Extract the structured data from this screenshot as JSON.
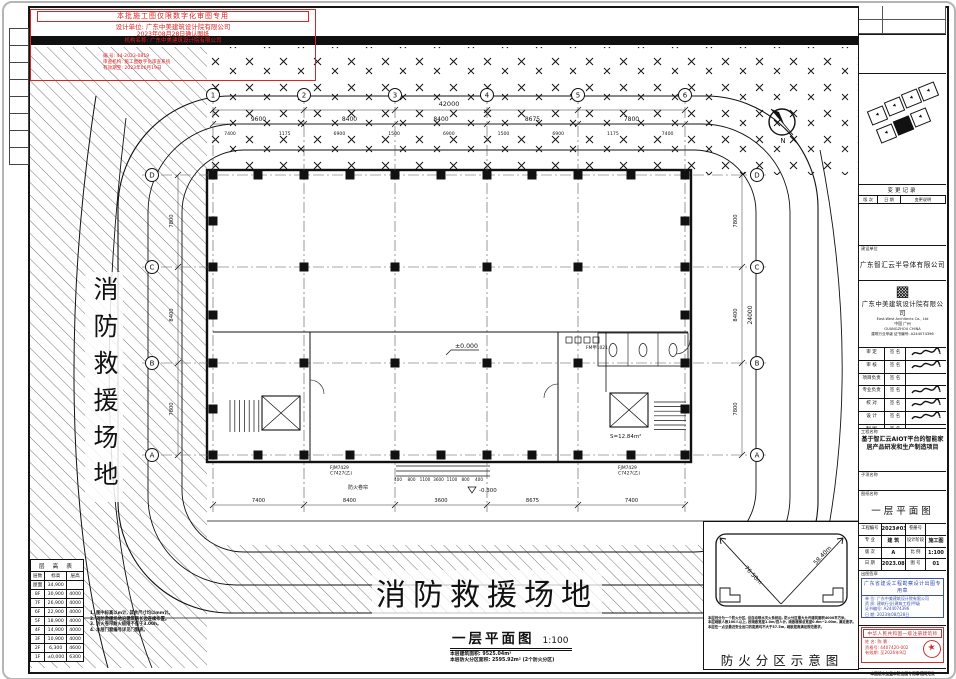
{
  "stamp": {
    "line1": "本批施工图仅限数字化审图专用",
    "line2": "设计单位: 广东中美建筑设计院有限公司",
    "line3": "2023年08月28日确认图纸",
    "line4": "机构名称: 广东中美建筑设计院有限公司",
    "small1": "编 号: 44-2023-0819",
    "small2": "审查机构: 施工图数字化审查系统",
    "small3": "有效期至: 2023年06月19日"
  },
  "plan": {
    "grid_top": [
      "1",
      "2",
      "3",
      "4",
      "5",
      "6"
    ],
    "grid_right": [
      "D",
      "C",
      "B",
      "A"
    ],
    "grid_left": [
      "D",
      "C",
      "B",
      "A"
    ],
    "dim_total_top": "42000",
    "dims_top": [
      "9600",
      "8400",
      "8400",
      "8675",
      "7800"
    ],
    "dims_top_inner": [
      "7400",
      "1175",
      "6900",
      "1500",
      "6900",
      "1500",
      "6900",
      "1175",
      "7400"
    ],
    "dims_bottom": [
      "7400",
      "8400",
      "3600",
      "8675",
      "7400"
    ],
    "dim_total_right": "24000",
    "dims_right": [
      "7800",
      "8400",
      "7800"
    ],
    "dims_left": [
      "7800",
      "8400",
      "7800"
    ],
    "dims_entrance": [
      "400",
      "800",
      "1100",
      "3600",
      "1100",
      "800",
      "400"
    ],
    "level_center": "±0.000",
    "level_outdoor": "-0.300",
    "room_area": "S=12.84m²",
    "tag_window1": "FJM7429",
    "tag_window1b": "C7427(乙)",
    "tag_window2": "FJM7429",
    "tag_window2b": "C7427(乙)",
    "tag_firedoor": "FM甲1021",
    "tag_shutter": "防火卷帘",
    "north": "N",
    "left_band_text": "消防救援场地",
    "bottom_band_text": "消防救援场地",
    "title": "一层平面图",
    "scale": "1:100",
    "area_line1": "本层建筑面积: 9525.04m²",
    "area_line2": "本层防火分区面积: 2595.92m² (2个防火分区)"
  },
  "floor_table": {
    "title": "层 高 表",
    "headers": [
      "层数",
      "标高",
      "层高"
    ],
    "rows": [
      [
        "屋面",
        "34,900",
        ""
      ],
      [
        "8F",
        "30,900",
        "4000"
      ],
      [
        "7F",
        "26,900",
        "4000"
      ],
      [
        "6F",
        "22,900",
        "4000"
      ],
      [
        "5F",
        "18,900",
        "4000"
      ],
      [
        "4F",
        "14,900",
        "4000"
      ],
      [
        "3F",
        "10,900",
        "4000"
      ],
      [
        "2F",
        "6,300",
        "4600"
      ],
      [
        "1F",
        "±0,000",
        "6300"
      ]
    ]
  },
  "notes": {
    "lines": [
      "1. 图中标高以m计, 其余尺寸均以mm计。",
      "2. 消防救援场地沿建筑两长边连续布置。",
      "3. 防火卷帘耐火极限不低于3.00h。",
      "4. 本层门窗编号详见门窗表。"
    ]
  },
  "fire_diagram": {
    "title": "防火分区示意图",
    "diag_left": "76.50m",
    "diag_right": "58.40m",
    "notes": [
      "本层划分为一个防火分区, 设自动喷水灭火系统后, 防火分区最大允许建筑面积4000平方米。",
      "本层疏散人数100人以上, 按疏散宽度1.0m/百人计, 疏散楼梯总宽度0.6m~2.00m, 满足要求。",
      "本层任一点至最近安全出口的距离均不大于37.5m, 疏散距离满足规范要求。"
    ]
  },
  "titleblock": {
    "client_label": "建设单位",
    "client": "广东智汇云半导体有限公司",
    "firm_logo": "▩",
    "firm": "广东中美建筑设计院有限公司",
    "firm_en": "East-West Architects Co., Ltd",
    "firm_city": "中国 广州",
    "firm_city_en": "GUANGZHOU CHINA",
    "firm_cert": "建筑行业甲级 证书编号: A244074396",
    "rev_title": "变更记录",
    "rev_headers": [
      "版 次",
      "日 期",
      "变更说明"
    ],
    "rev_sub": [
      "NO.",
      "DATE",
      "DESCRIPTION"
    ],
    "roles": [
      [
        "审 定",
        "签 名"
      ],
      [
        "审 核",
        "签 名"
      ],
      [
        "项目负责",
        "签 名"
      ],
      [
        "专业负责",
        "签 名"
      ],
      [
        "校 对",
        "签 名"
      ],
      [
        "设 计",
        "签 名"
      ],
      [
        "制 图",
        "签 名"
      ]
    ],
    "project_label": "工程名称",
    "project": "基于智汇云AIOT平台的智能家居产品研发和生产制造项目",
    "subitem_label": "子项名称",
    "drawing_label": "图纸名称",
    "drawing": "一层平面图",
    "fields": [
      [
        "工程编号",
        "2023#031",
        "卷册号",
        ""
      ],
      [
        "专 业",
        "建 筑",
        "设计阶段",
        "施工图"
      ],
      [
        "版 次",
        "A",
        "比 例",
        "1:100"
      ],
      [
        "日 期",
        "2023.08",
        "图 号",
        "01"
      ]
    ],
    "stamp_out_label": "出图签章",
    "stamp_out": {
      "title": "广东省建设工程勘察设计出图专用章",
      "l1": "单 位: 广东中美建筑设计院有限公司",
      "l2": "资 质: 建筑行业(建筑工程)甲级",
      "l3": "证书编号: A244074396",
      "l4": "日 期: 2023年08月28日"
    },
    "stamp_reg_label": "执业签章",
    "stamp_reg": {
      "title": "中华人民共和国一级注册建筑师",
      "l1": "姓 名: 陈 寰",
      "l2": "资格号: 4407420-002",
      "l3": "有效期: 至2026年9月",
      "seal": "★"
    },
    "footnote": "本图纸未加盖本院出图专用章视同无效"
  }
}
